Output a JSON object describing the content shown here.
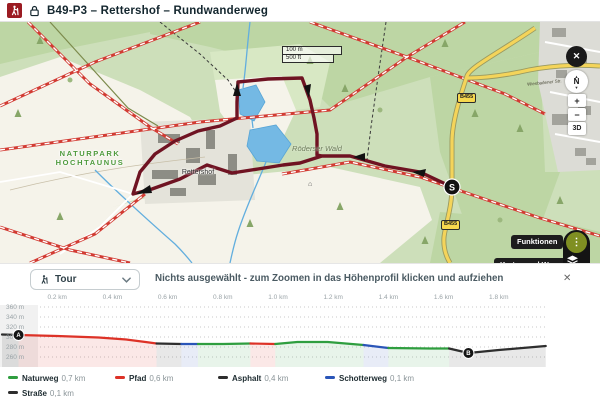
{
  "header": {
    "title": "B49-P3 – Rettershof – Rundwanderweg"
  },
  "map": {
    "scale_metric": "100 m",
    "scale_imperial": "500 ft",
    "naturpark_line1": "NATURPARK",
    "naturpark_line2": "HOCHTAUNUS",
    "rettershof_label": "Rettershof",
    "forest_label": "Röderser Wald",
    "road_badge": "B455",
    "road_name": "Wiesbadener Str.",
    "start_marker": "S",
    "compass_n": "N",
    "zoom_in": "+",
    "zoom_out": "−",
    "mode_3d": "3D",
    "close": "✕",
    "btn_funktionen": "Funktionen",
    "btn_karten": "Karten und Wege",
    "more_icon": "⋮",
    "watermark": "outdooractive",
    "attribution": "© Outdooractive © swisstopo © IGN © OpenStreetMap",
    "route_color": "#6f1322",
    "road_color": "#f4d45a"
  },
  "panel": {
    "tour_label": "Tour",
    "message": "Nichts ausgewählt - zum Zoomen in das Höhenprofil klicken und aufziehen",
    "close": "✕"
  },
  "chart_data": {
    "type": "area",
    "title": "Höhenprofil (elevation profile)",
    "xlabel": "distance (km)",
    "ylabel": "elevation (m)",
    "x_ticks": [
      {
        "km": 0.2,
        "label": "0.2 km"
      },
      {
        "km": 0.4,
        "label": "0.4 km"
      },
      {
        "km": 0.6,
        "label": "0.6 km"
      },
      {
        "km": 0.8,
        "label": "0.8 km"
      },
      {
        "km": 1.0,
        "label": "1.0 km"
      },
      {
        "km": 1.2,
        "label": "1.2 km"
      },
      {
        "km": 1.4,
        "label": "1.4 km"
      },
      {
        "km": 1.6,
        "label": "1.6 km"
      },
      {
        "km": 1.8,
        "label": "1.8 km"
      }
    ],
    "y_ticks": [
      {
        "m": 360,
        "label": "360 m"
      },
      {
        "m": 340,
        "label": "340 m"
      },
      {
        "m": 320,
        "label": "320 m"
      },
      {
        "m": 300,
        "label": "300 m"
      },
      {
        "m": 280,
        "label": "280 m"
      },
      {
        "m": 260,
        "label": "260 m"
      }
    ],
    "xlim_km": [
      0,
      1.97
    ],
    "ylim_m": [
      250,
      370
    ],
    "grid": true,
    "segments": [
      {
        "surface": "Straße",
        "color": "#2e2e2e",
        "points": [
          [
            0.0,
            305
          ],
          [
            0.06,
            304
          ]
        ]
      },
      {
        "surface": "Pfad",
        "color": "#dd3227",
        "points": [
          [
            0.06,
            304
          ],
          [
            0.2,
            302
          ],
          [
            0.35,
            299
          ],
          [
            0.45,
            295
          ],
          [
            0.52,
            290
          ],
          [
            0.56,
            287
          ]
        ]
      },
      {
        "surface": "Asphalt",
        "color": "#2e2e2e",
        "points": [
          [
            0.56,
            287
          ],
          [
            0.65,
            286
          ]
        ]
      },
      {
        "surface": "Schotterweg",
        "color": "#2a55b8",
        "points": [
          [
            0.65,
            286
          ],
          [
            0.71,
            286
          ]
        ]
      },
      {
        "surface": "Naturweg",
        "color": "#2f9e3f",
        "points": [
          [
            0.71,
            286
          ],
          [
            0.8,
            286
          ],
          [
            0.9,
            287
          ]
        ]
      },
      {
        "surface": "Pfad",
        "color": "#dd3227",
        "points": [
          [
            0.9,
            287
          ],
          [
            0.99,
            286
          ]
        ]
      },
      {
        "surface": "Naturweg",
        "color": "#2f9e3f",
        "points": [
          [
            0.99,
            286
          ],
          [
            1.07,
            290
          ],
          [
            1.18,
            290
          ],
          [
            1.31,
            284
          ]
        ]
      },
      {
        "surface": "Schotterweg",
        "color": "#2a55b8",
        "points": [
          [
            1.31,
            284
          ],
          [
            1.4,
            278
          ]
        ]
      },
      {
        "surface": "Naturweg",
        "color": "#2f9e3f",
        "points": [
          [
            1.4,
            278
          ],
          [
            1.55,
            277
          ],
          [
            1.62,
            277
          ]
        ]
      },
      {
        "surface": "Asphalt",
        "color": "#2e2e2e",
        "points": [
          [
            1.62,
            277
          ],
          [
            1.69,
            268
          ],
          [
            1.8,
            274
          ],
          [
            1.97,
            282
          ]
        ]
      }
    ],
    "markers": [
      {
        "label": "A",
        "km": 0.06,
        "m": 304
      },
      {
        "label": "B",
        "km": 1.69,
        "m": 268
      }
    ],
    "legend": [
      {
        "label": "Naturweg",
        "value": "0,7 km",
        "color": "#2f9e3f"
      },
      {
        "label": "Pfad",
        "value": "0,6 km",
        "color": "#dd3227"
      },
      {
        "label": "Asphalt",
        "value": "0,4 km",
        "color": "#2e2e2e"
      },
      {
        "label": "Schotterweg",
        "value": "0,1 km",
        "color": "#2a55b8"
      },
      {
        "label": "Straße",
        "value": "0,1 km",
        "color": "#2e2e2e"
      }
    ]
  }
}
